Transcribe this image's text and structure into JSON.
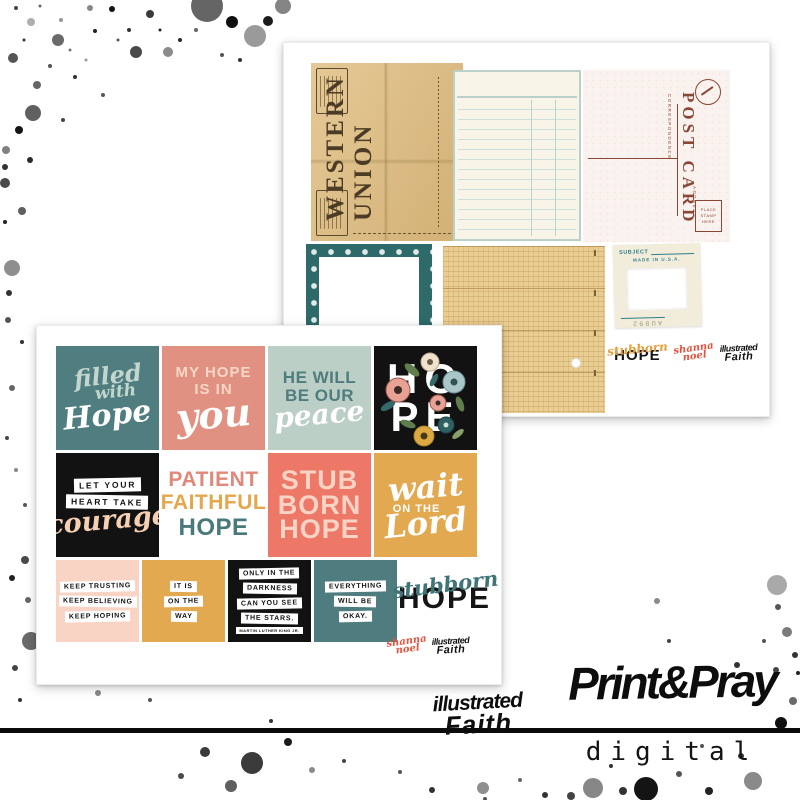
{
  "front_sheet": {
    "cards": {
      "filled": {
        "l1": "filled",
        "l2": "with",
        "l3": "Hope"
      },
      "my_hope": {
        "l1": "MY HOPE",
        "l2": "IS IN",
        "l3": "you"
      },
      "peace": {
        "l1": "HE WILL",
        "l2": "BE OUR",
        "l3": "peace"
      },
      "hope_floral": {
        "l1": "HO",
        "l2": "PE"
      },
      "courage": {
        "l1": "LET YOUR",
        "l2": "HEART TAKE",
        "l3": "courage"
      },
      "patient": {
        "l1": "PATIENT",
        "l2": "FAITHFUL",
        "l3": "HOPE"
      },
      "stubborn": {
        "l1": "STUB",
        "l2": "BORN",
        "l3": "HOPE"
      },
      "wait": {
        "l1": "wait",
        "l2": "ON THE",
        "l3": "Lord"
      },
      "keep": {
        "l1": "KEEP TRUSTING",
        "l2": "KEEP BELIEVING",
        "l3": "KEEP HOPING"
      },
      "on_the_way": {
        "l1": "IT IS",
        "l2": "ON THE",
        "l3": "WAY"
      },
      "stars": {
        "l1": "ONLY IN THE",
        "l2": "DARKNESS",
        "l3": "CAN YOU SEE",
        "l4": "THE STARS.",
        "credit": "MARTIN LUTHER KING JR."
      },
      "okay": {
        "l1": "EVERYTHING",
        "l2": "WILL BE",
        "l3": "OKAY."
      },
      "stubborn_hope": {
        "l1": "stubborn",
        "l2": "HOPE"
      }
    },
    "branding": {
      "shanna_l1": "shanna",
      "shanna_l2": "noel",
      "faith_l1": "illustrated",
      "faith_l2": "Faith"
    }
  },
  "back_sheet": {
    "western_union": {
      "w1": "WESTERN",
      "w2": "UNION"
    },
    "postcard": {
      "title": "POST CARD",
      "correspondence": "CORRESPONDENCE",
      "address": "ADDRESS",
      "stamp_l1": "PLACE",
      "stamp_l2": "STAMP",
      "stamp_l3": "HERE"
    },
    "slide_mount": {
      "subject": "SUBJECT",
      "made_in": "MADE IN U.S.A.",
      "code": "AU092"
    },
    "branding": {
      "stub_l1": "stubborn",
      "stub_l2": "HOPE",
      "shanna_l1": "shanna",
      "shanna_l2": "noel",
      "faith_l1": "illustrated",
      "faith_l2": "Faith"
    }
  },
  "footer": {
    "faith_l1": "illustrated",
    "faith_l2": "Faith",
    "brand": "Print&Pray",
    "sub": "digital"
  },
  "icons": {
    "postcard_emblem": "postal-crest-circle",
    "flowers": "floral-illustration",
    "punch_hole": "hole-punch-dot",
    "ink_splatter": "ink-splatter-dots"
  },
  "colors": {
    "teal": "#4f7c7e",
    "mint": "#bccfc7",
    "salmon": "#e09181",
    "coral": "#ee7868",
    "mustard": "#e3a951",
    "blush": "#f9d4c4",
    "black": "#141414",
    "postcard_brown": "#8a4736",
    "telegram_tan": "#dcba7e",
    "grid_tan": "#e9cd92",
    "frame_teal": "#2e6a6a",
    "shanna_red": "#e2543f"
  }
}
